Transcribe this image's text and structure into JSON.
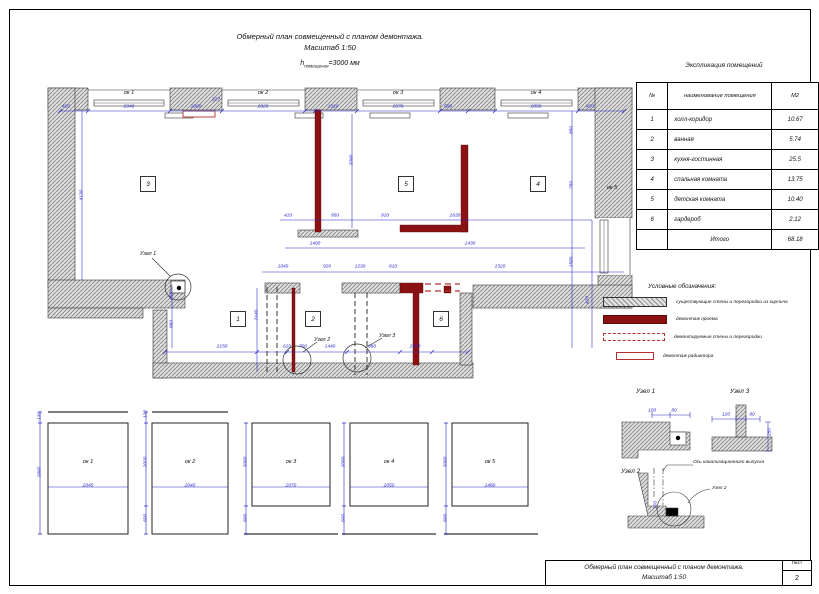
{
  "title": {
    "line1": "Обмерный план совмещенный с планом демонтажа.",
    "line2": "Масштаб 1:50",
    "h_base": "h",
    "h_sub": "помещения",
    "h_rest": "=3000 мм"
  },
  "table": {
    "title": "Экспликация помещений",
    "headers": {
      "num": "№",
      "name": "наименование помещения",
      "area": "М2"
    },
    "rows": [
      {
        "num": "1",
        "name": "холл-коридор",
        "area": "10.67"
      },
      {
        "num": "2",
        "name": "ванная",
        "area": "5.74"
      },
      {
        "num": "3",
        "name": "кухня-гостинная",
        "area": "25.5"
      },
      {
        "num": "4",
        "name": "спальная комната",
        "area": "13.75"
      },
      {
        "num": "5",
        "name": "детская комната",
        "area": "10.40"
      },
      {
        "num": "6",
        "name": "гардероб",
        "area": "2.12"
      },
      {
        "num": "",
        "name": "Итого",
        "area": "68.18"
      }
    ]
  },
  "legend": {
    "title": "Условные обозначения:",
    "items": [
      {
        "label": "существующие стены и перегородки из кирпича"
      },
      {
        "label": "демонтаж проема"
      },
      {
        "label": "демонтируемые стены и перегородки"
      },
      {
        "label": "демонтаж радиатора"
      }
    ]
  },
  "plan": {
    "room_numbers": [
      "3",
      "5",
      "4",
      "1",
      "2",
      "6"
    ],
    "windows": [
      "ок 1",
      "ок 2",
      "ок 3",
      "ок 4",
      "ок 5"
    ],
    "nodes": {
      "n1": "Узел 1",
      "n2": "Узел 2",
      "n3": "Узел 3"
    }
  },
  "details": {
    "n1": "Узел 1",
    "n2": "Узел 2",
    "n3": "Узел 3",
    "axis_label": "Ось канализационного выпуска",
    "n2_ref": "Узел 2"
  },
  "elevations": {
    "labels": [
      "ок 1",
      "ок 2",
      "ок 3",
      "ок 4",
      "ок 5"
    ],
    "widths": [
      "2040",
      "2040",
      "2070",
      "2050",
      "1480"
    ]
  },
  "titleblock": {
    "line1": "Обмерный план совмещенный с планом демонтажа.",
    "line2": "Масштаб 1:50",
    "sheet_label": "Лист",
    "sheet_number": "2"
  },
  "dims": [
    [
      66,
      107,
      "420"
    ],
    [
      129,
      107,
      "2040"
    ],
    [
      196,
      107,
      "1000"
    ],
    [
      216,
      100,
      "227"
    ],
    [
      263,
      107,
      "2020"
    ],
    [
      333,
      107,
      "1310"
    ],
    [
      398,
      107,
      "2070"
    ],
    [
      448,
      107,
      "500"
    ],
    [
      536,
      107,
      "2050"
    ],
    [
      590,
      107,
      "420"
    ],
    [
      572,
      130,
      "850",
      1
    ],
    [
      572,
      185,
      "750",
      1
    ],
    [
      572,
      262,
      "1580",
      1
    ],
    [
      588,
      300,
      "420",
      1
    ],
    [
      82,
      195,
      "4130",
      1
    ],
    [
      352,
      160,
      "2060",
      1
    ],
    [
      288,
      216,
      "410"
    ],
    [
      335,
      216,
      "950"
    ],
    [
      385,
      216,
      "910"
    ],
    [
      455,
      216,
      "1630"
    ],
    [
      315,
      244,
      "1400"
    ],
    [
      470,
      244,
      "1430"
    ],
    [
      283,
      267,
      "1040"
    ],
    [
      327,
      267,
      "920"
    ],
    [
      360,
      267,
      "1230"
    ],
    [
      393,
      267,
      "810"
    ],
    [
      500,
      267,
      "1320"
    ],
    [
      222,
      347,
      "2150"
    ],
    [
      287,
      347,
      "610"
    ],
    [
      303,
      347,
      "700"
    ],
    [
      330,
      347,
      "1440"
    ],
    [
      372,
      347,
      "860"
    ],
    [
      415,
      347,
      "2380"
    ],
    [
      172,
      296,
      "450",
      1
    ],
    [
      172,
      324,
      "860",
      1
    ],
    [
      257,
      315,
      "2140",
      1
    ],
    [
      88,
      486,
      "2040"
    ],
    [
      190,
      486,
      "2040"
    ],
    [
      291,
      486,
      "2070"
    ],
    [
      389,
      486,
      "2050"
    ],
    [
      490,
      486,
      "1480"
    ],
    [
      40,
      472,
      "2660",
      1
    ],
    [
      40,
      416,
      "120",
      1
    ],
    [
      146,
      414,
      "120",
      1
    ],
    [
      146,
      462,
      "2000",
      1
    ],
    [
      146,
      518,
      "600",
      1
    ],
    [
      246,
      462,
      "2060",
      1
    ],
    [
      246,
      518,
      "600",
      1
    ],
    [
      344,
      462,
      "2060",
      1
    ],
    [
      344,
      518,
      "600",
      1
    ],
    [
      446,
      462,
      "2060",
      1
    ],
    [
      446,
      518,
      "600",
      1
    ],
    [
      652,
      411,
      "100"
    ],
    [
      674,
      411,
      "80"
    ],
    [
      726,
      415,
      "120"
    ],
    [
      752,
      415,
      "80"
    ],
    [
      770,
      432,
      "250",
      1
    ],
    [
      656,
      505,
      "100",
      1
    ]
  ]
}
